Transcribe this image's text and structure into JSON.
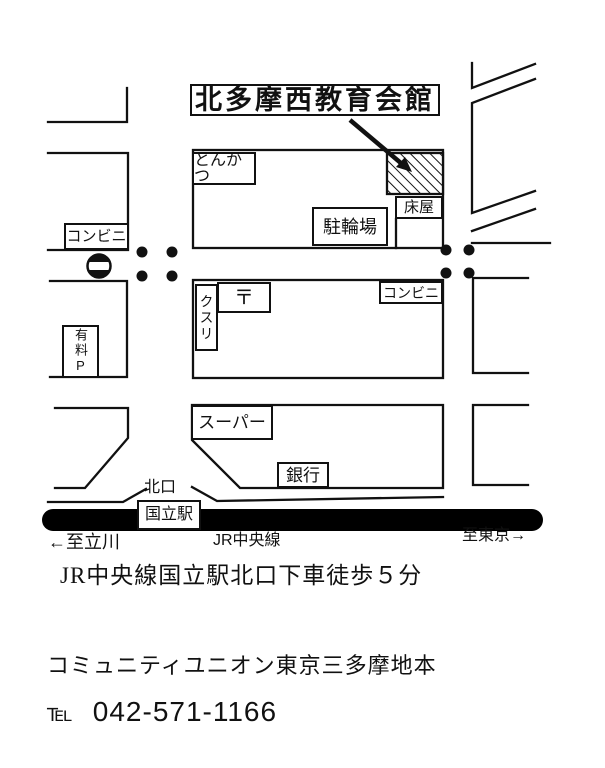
{
  "colors": {
    "ink": "#111111",
    "paper": "#ffffff",
    "rail": "#000000"
  },
  "map": {
    "title": "北多摩西教育会館",
    "buildings": {
      "tonkatsu": "とんかつ",
      "barber": "床屋",
      "bicycle_parking": "駐輪場",
      "convenience_west": "コンビニ",
      "convenience_east": "コンビニ",
      "drugstore": "クスリ",
      "post_office": "〒",
      "paid_parking": "有料P",
      "supermarket": "スーパー",
      "bank": "銀行"
    },
    "station": {
      "north_exit": "北口",
      "name": "国立駅",
      "line": "JR中央線",
      "to_west": "←至立川",
      "to_east": "至東京→"
    }
  },
  "caption": "JR中央線国立駅北口下車徒歩５分",
  "footer": {
    "org": "コミュニティユニオン東京三多摩地本",
    "tel_label": "℡",
    "tel_number": "042-571-1166"
  }
}
